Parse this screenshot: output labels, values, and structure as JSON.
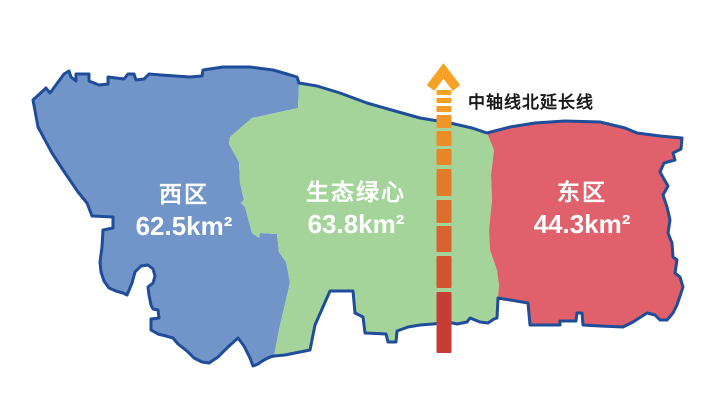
{
  "map": {
    "background": "#FFFFFF",
    "outline_color": "#1F4D99",
    "regions": [
      {
        "id": "west",
        "name": "西区",
        "area": "62.5km²",
        "fill": "#7195C9"
      },
      {
        "id": "green-heart",
        "name": "生态绿心",
        "area": "63.8km²",
        "fill": "#A5D49B"
      },
      {
        "id": "east",
        "name": "东区",
        "area": "44.3km²",
        "fill": "#E0606B"
      }
    ],
    "axis_line": {
      "label": "中轴线北延长线",
      "direction": "north",
      "gradient_top": "#F5A225",
      "gradient_bottom": "#C73D36"
    }
  }
}
